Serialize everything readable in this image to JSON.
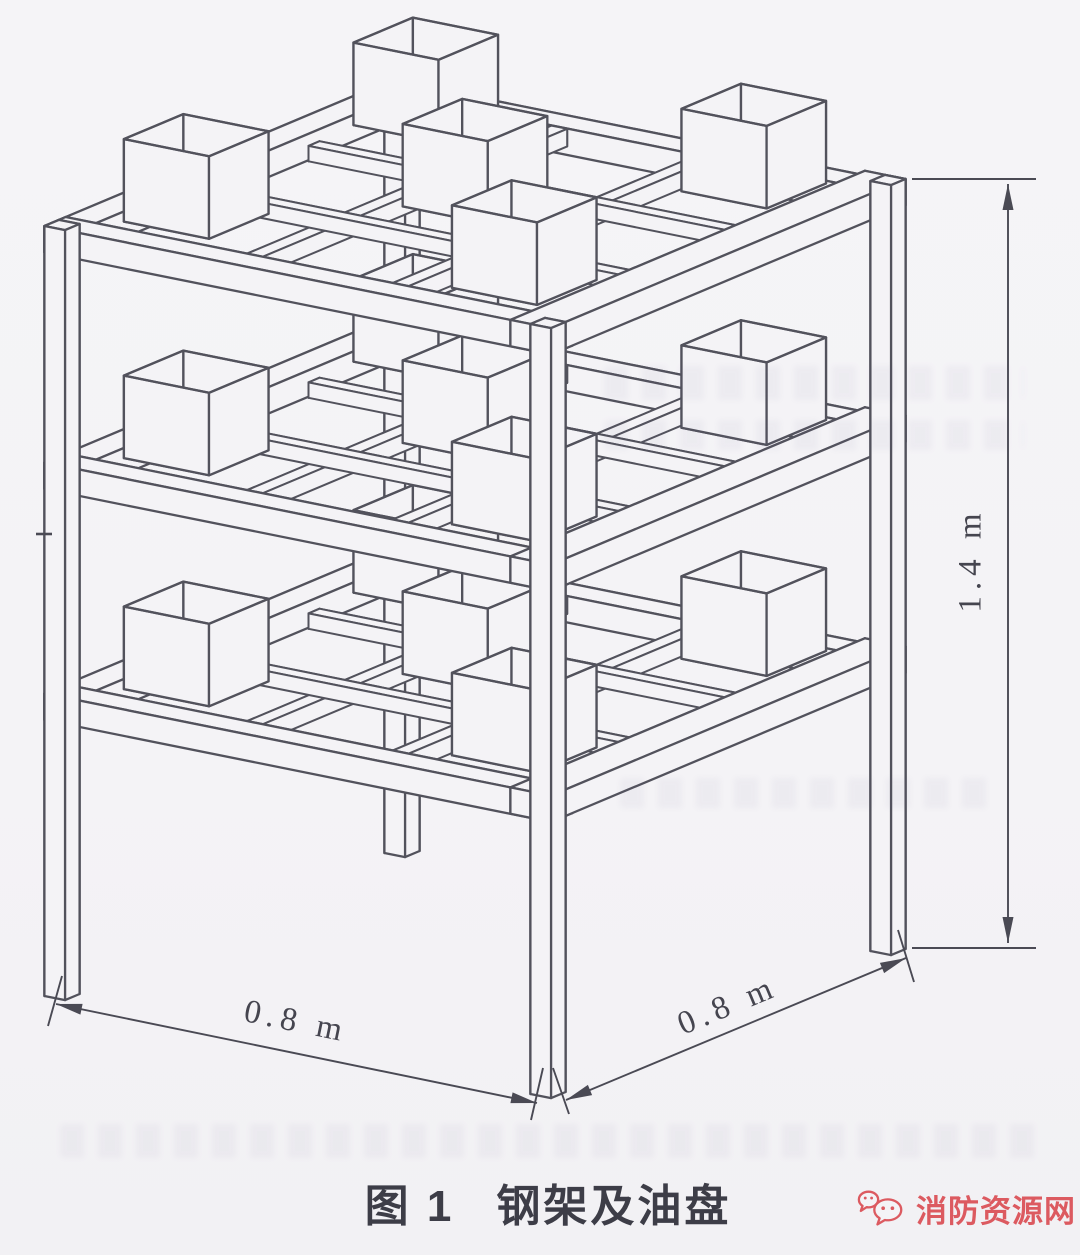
{
  "figure": {
    "label": "图 1",
    "title": "钢架及油盘",
    "dimensions": {
      "width_left": "0.8 m",
      "width_right": "0.8 m",
      "height": "1.4 m"
    },
    "structure": {
      "type": "isometric-steel-frame-with-oil-pans",
      "tiers": 3,
      "pans_per_tier": 5,
      "posts": 4,
      "base_width_m": 0.8,
      "base_depth_m": 0.8,
      "height_m": 1.4
    },
    "colors": {
      "line": "#52525c",
      "dim_line": "#4a4a54",
      "paper": "#f4f3f6",
      "text": "#3d3d47",
      "watermark": "#dc5a60"
    }
  },
  "watermark": {
    "text": "消防资源网",
    "icon": "chat-bubbles-icon"
  }
}
